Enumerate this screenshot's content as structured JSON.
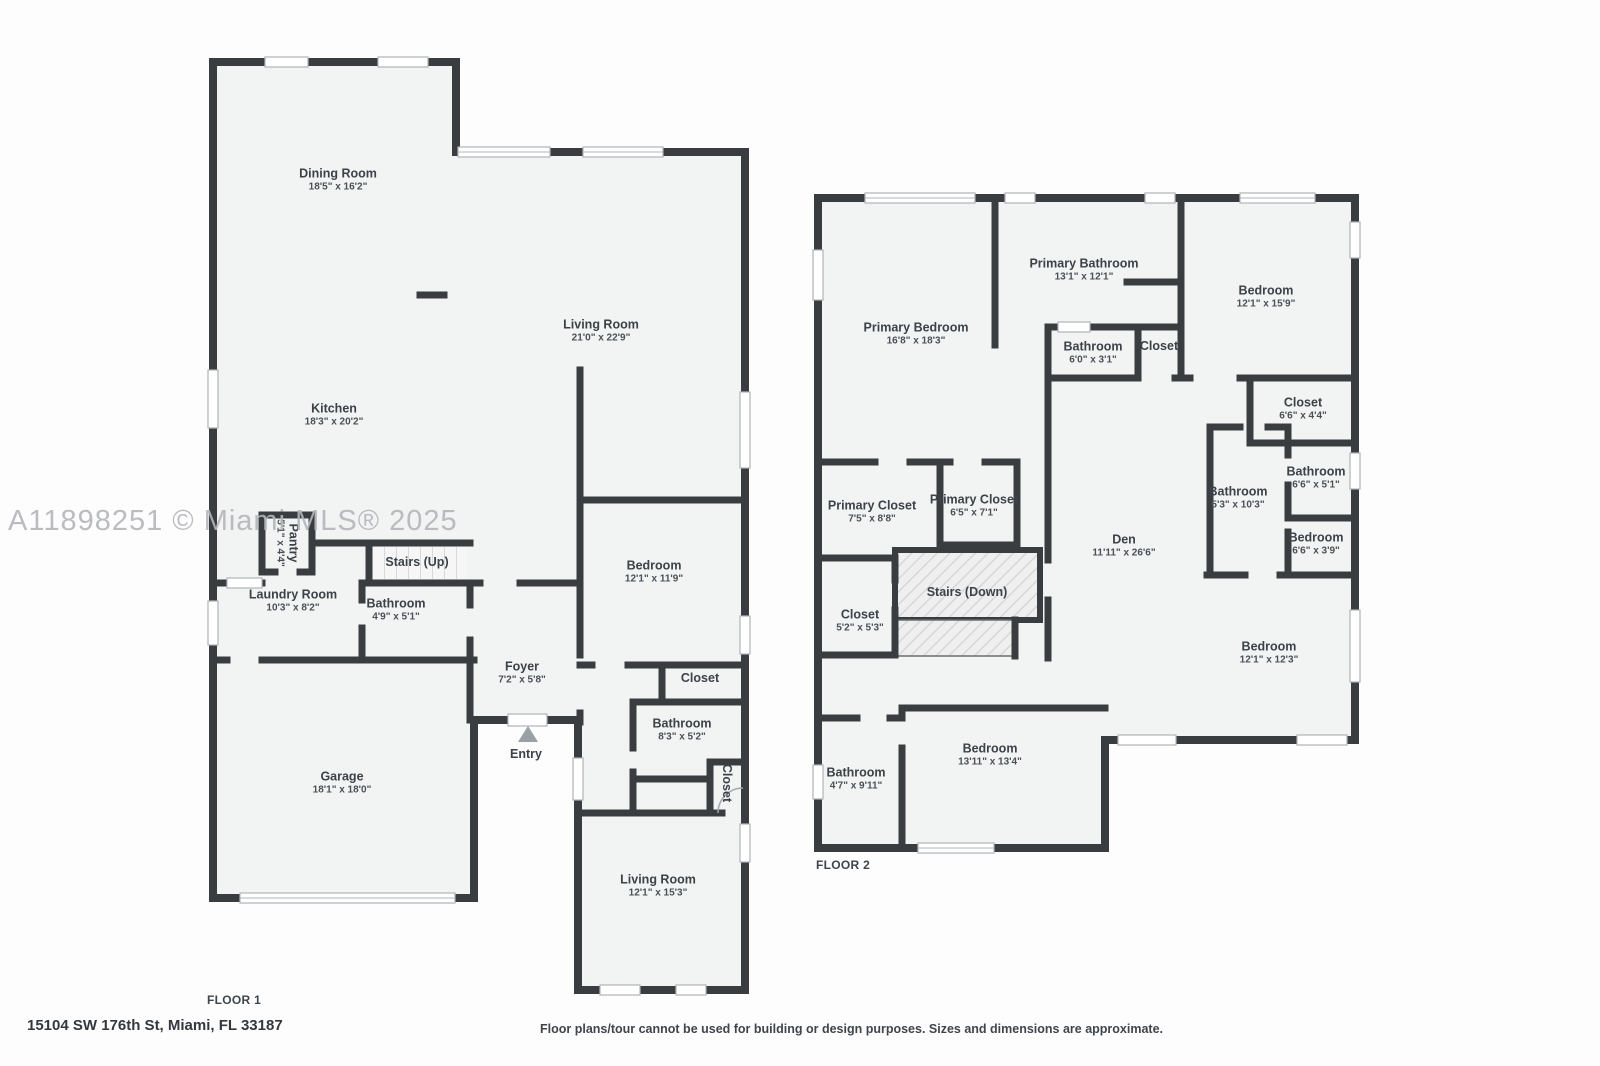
{
  "watermark": "A11898251 © Miami MLS® 2025",
  "footer": {
    "address": "15104 SW 176th St, Miami, FL 33187",
    "disclaimer": "Floor plans/tour cannot be used for building or design purposes. Sizes and dimensions are approximate."
  },
  "colors": {
    "wall": "#3a3d40",
    "room_fill": "#f2f3f3",
    "label": "#3c4248",
    "watermark": "#b2b5b9",
    "entry_arrow": "#9aa1a6"
  },
  "floor1": {
    "label": "FLOOR 1",
    "entry": "Entry",
    "rooms": [
      {
        "name": "Dining Room",
        "dims": "18'5\" x 16'2\""
      },
      {
        "name": "Living Room",
        "dims": "21'0\" x 22'9\""
      },
      {
        "name": "Kitchen",
        "dims": "18'3\" x 20'2\""
      },
      {
        "name": "Pantry",
        "dims": "5'1\" x 4'4\""
      },
      {
        "name": "Stairs (Up)",
        "dims": ""
      },
      {
        "name": "Laundry Room",
        "dims": "10'3\" x 8'2\""
      },
      {
        "name": "Bathroom",
        "dims": "4'9\" x 5'1\""
      },
      {
        "name": "Foyer",
        "dims": "7'2\" x 5'8\""
      },
      {
        "name": "Bedroom",
        "dims": "12'1\" x 11'9\""
      },
      {
        "name": "Closet",
        "dims": ""
      },
      {
        "name": "Bathroom",
        "dims": "8'3\" x 5'2\""
      },
      {
        "name": "Closet",
        "dims": ""
      },
      {
        "name": "Living Room",
        "dims": "12'1\" x 15'3\""
      },
      {
        "name": "Garage",
        "dims": "18'1\" x 18'0\""
      }
    ]
  },
  "floor2": {
    "label": "FLOOR 2",
    "rooms": [
      {
        "name": "Primary Bedroom",
        "dims": "16'8\" x 18'3\""
      },
      {
        "name": "Primary Bathroom",
        "dims": "13'1\" x 12'1\""
      },
      {
        "name": "Bathroom",
        "dims": "6'0\" x 3'1\""
      },
      {
        "name": "Closet",
        "dims": ""
      },
      {
        "name": "Bedroom",
        "dims": "12'1\" x 15'9\""
      },
      {
        "name": "Closet",
        "dims": "6'6\" x 4'4\""
      },
      {
        "name": "Bathroom",
        "dims": "5'3\" x 10'3\""
      },
      {
        "name": "Bathroom",
        "dims": "6'6\" x 5'1\""
      },
      {
        "name": "Bedroom",
        "dims": "6'6\" x 3'9\""
      },
      {
        "name": "Den",
        "dims": "11'11\" x 26'6\""
      },
      {
        "name": "Primary Closet",
        "dims": "7'5\" x 8'8\""
      },
      {
        "name": "Primary Closet",
        "dims": "6'5\" x 7'1\""
      },
      {
        "name": "Closet",
        "dims": "5'2\" x 5'3\""
      },
      {
        "name": "Stairs (Down)",
        "dims": ""
      },
      {
        "name": "Bedroom",
        "dims": "12'1\" x 12'3\""
      },
      {
        "name": "Bathroom",
        "dims": "4'7\" x 9'11\""
      },
      {
        "name": "Bedroom",
        "dims": "13'11\" x 13'4\""
      }
    ]
  }
}
